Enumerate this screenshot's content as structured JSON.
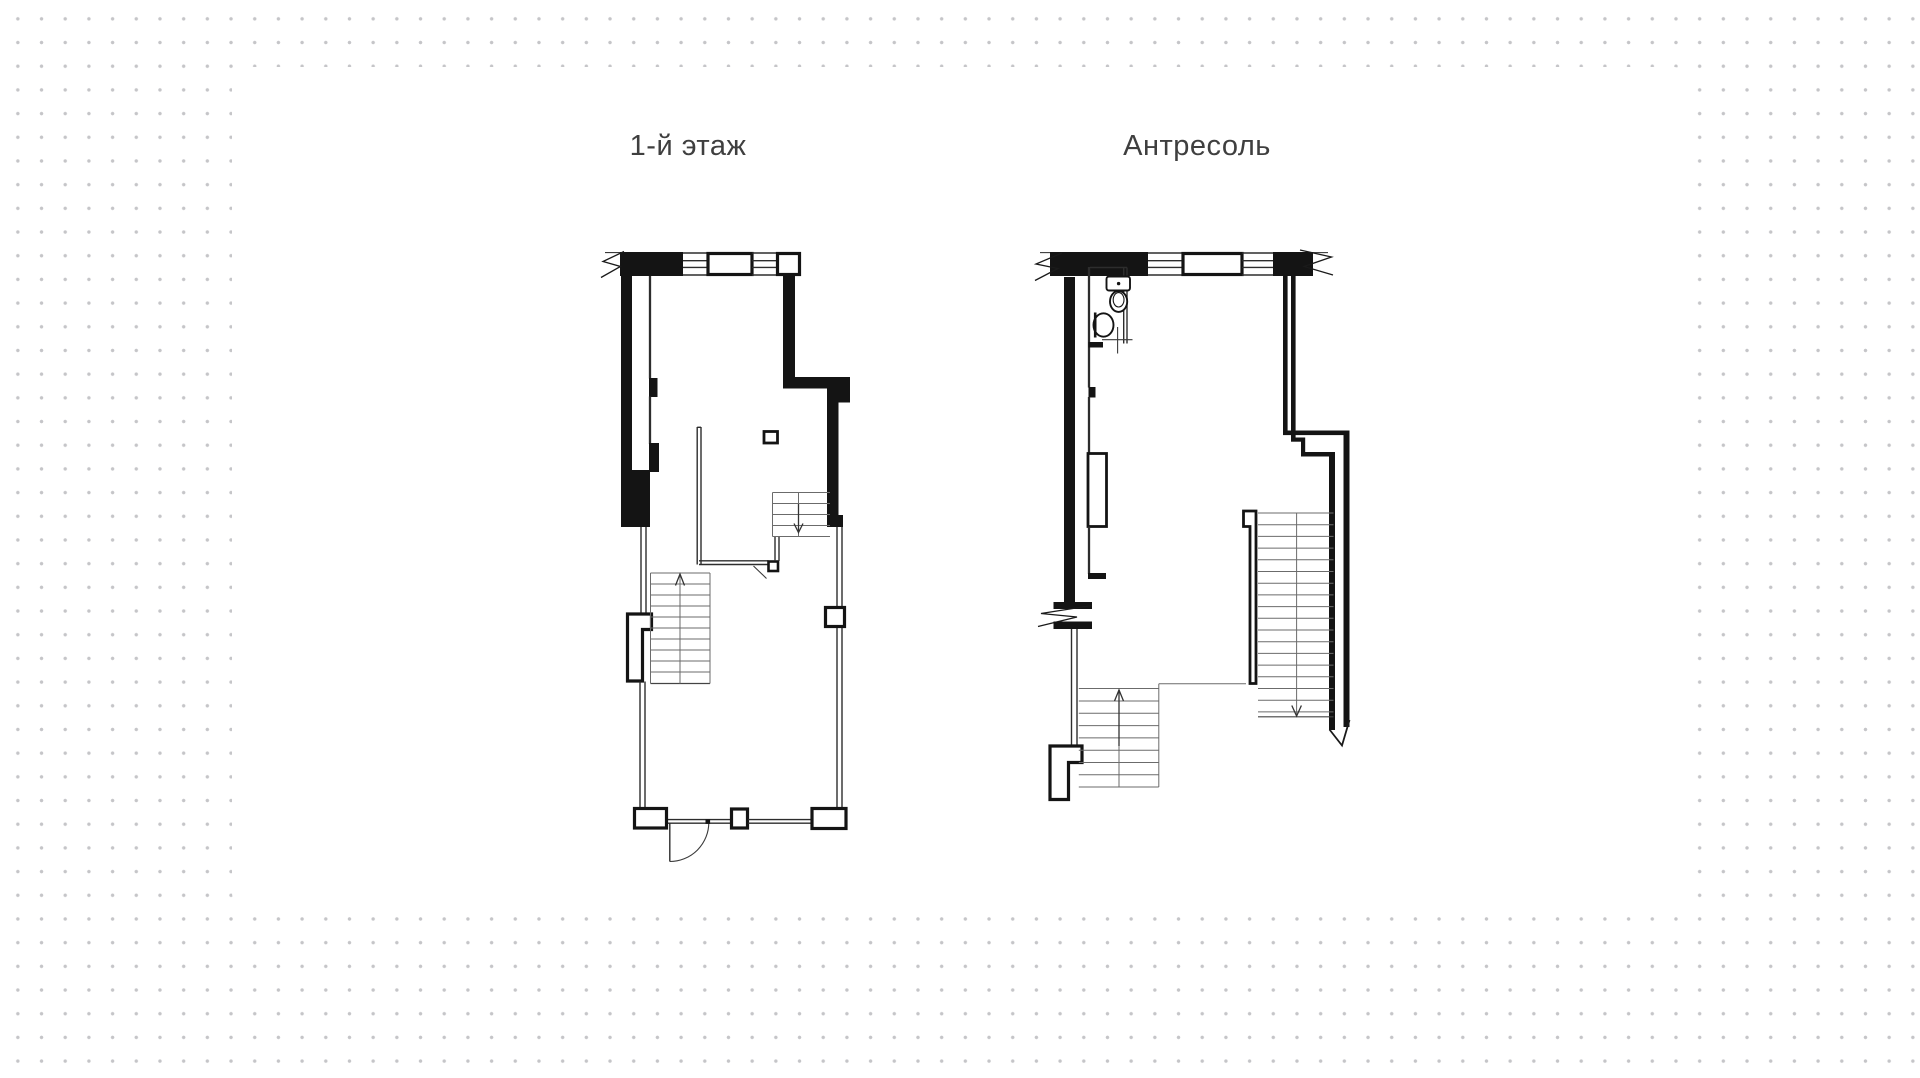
{
  "page": {
    "background": {
      "dot_color": "#c5c5c8",
      "dot_spacing_px": 23.7
    },
    "card": {
      "color": "#ffffff"
    }
  },
  "drawing": {
    "ink_color": "#141414",
    "stair_line_color": "#6b6b6b",
    "plans": [
      {
        "id": "floor-1",
        "title": "1-й этаж",
        "features": [
          "break-symbol",
          "windows",
          "entry-door-swing",
          "column",
          "partition",
          "stair-up-arrow",
          "stair-down-arrow"
        ]
      },
      {
        "id": "mezzanine",
        "title": "Антресоль",
        "features": [
          "break-symbols",
          "windows",
          "wc-toilet",
          "wc-sink",
          "door-axis-cross",
          "stair-up-arrow",
          "stair-down-arrow"
        ]
      }
    ]
  }
}
